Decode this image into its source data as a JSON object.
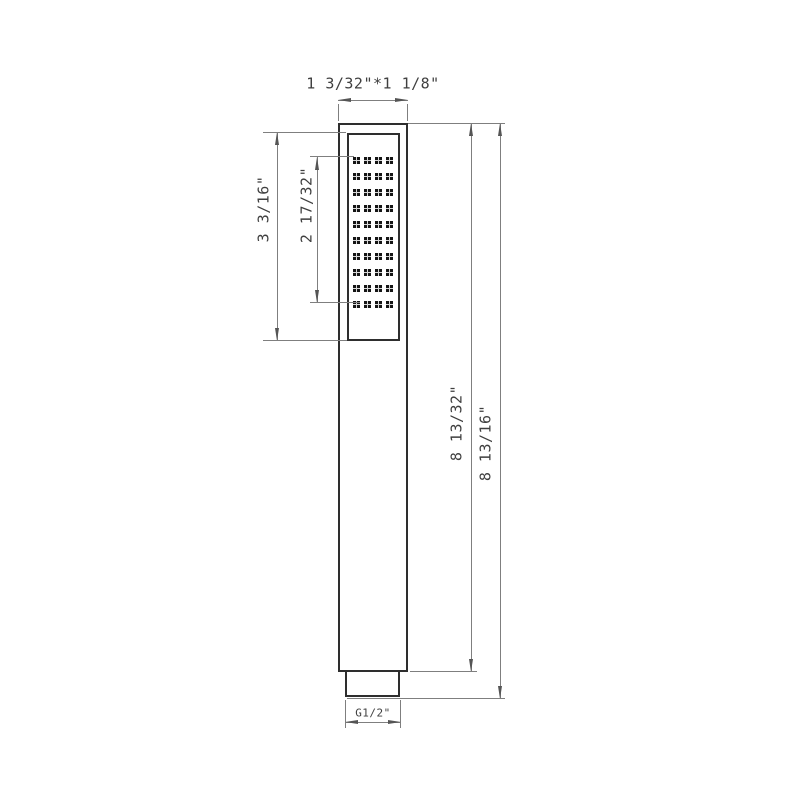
{
  "labels": {
    "head_face_size": "1 3/32\"*1 1/8\"",
    "faceplate_height": "3 3/16\"",
    "nozzle_field_height": "2 17/32\"",
    "body_length": "8 13/32\"",
    "overall_length": "8 13/16\"",
    "inlet_thread": "G1/2\""
  },
  "nozzle_grid": {
    "rows": 10,
    "cols": 4
  },
  "colors": {
    "object_line": "#2e2e2e",
    "dim_line": "#7f7f7f",
    "arrow": "#555555",
    "text": "#3f3f3f",
    "background": "#ffffff",
    "nozzle_dark": "#151515",
    "nozzle_cross": "#d9d9d9"
  }
}
